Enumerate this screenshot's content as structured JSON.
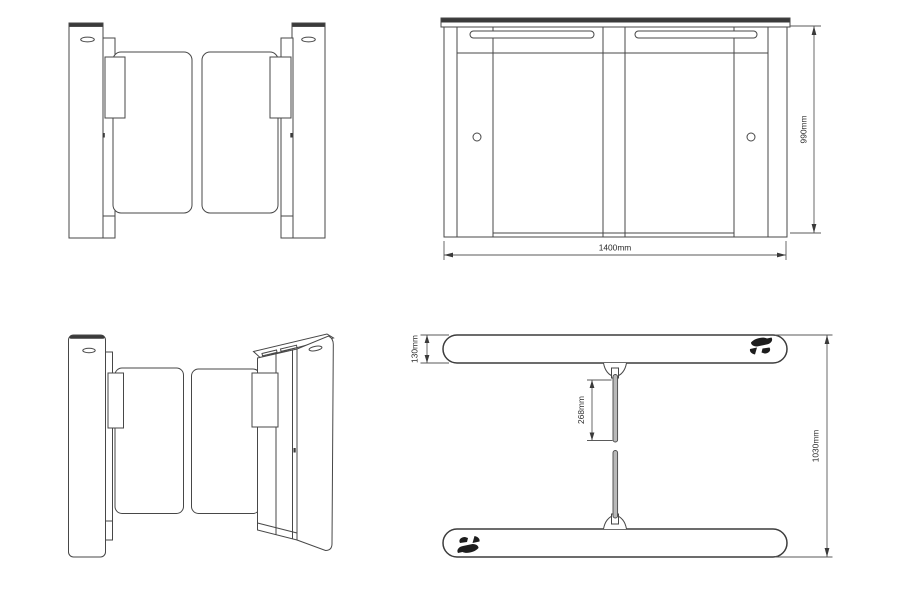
{
  "canvas": {
    "background": "#ffffff",
    "line_color": "#474747",
    "text_color": "#2b2b2b"
  },
  "dimensions": {
    "side_view": {
      "width": "1400mm",
      "height": "990mm"
    },
    "plan_view": {
      "cabinet_depth": "130mm",
      "wing_length": "268mm",
      "overall_depth": "1030mm"
    }
  },
  "icons": {
    "card_reader": "card-reader-hand-icon"
  }
}
